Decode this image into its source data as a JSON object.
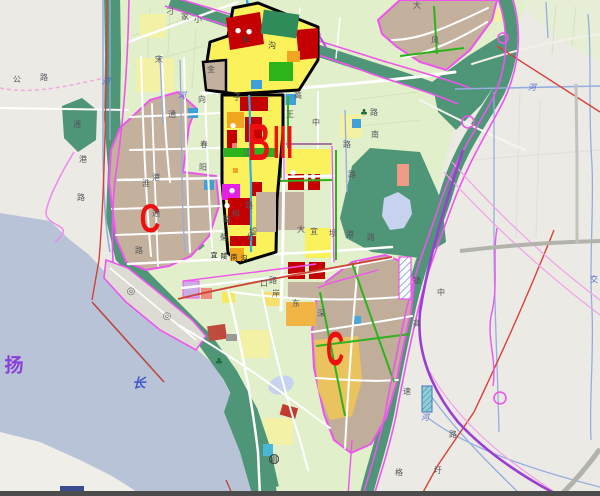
{
  "map": {
    "district_letters": [
      {
        "name": "district-label-c-west",
        "text": "C",
        "x": 150,
        "y": 219,
        "size": 40,
        "sx": 0.72,
        "c": "#ee0f0f"
      },
      {
        "name": "district-label-b",
        "text": "B",
        "x": 259,
        "y": 143,
        "size": 52,
        "sx": 0.6,
        "c": "#ee0f0f"
      },
      {
        "name": "district-label-iii",
        "text": "III",
        "x": 283,
        "y": 142,
        "size": 46,
        "sx": 0.52,
        "c": "#ee0f0f"
      },
      {
        "name": "district-label-c-south",
        "text": "C",
        "x": 335,
        "y": 350,
        "size": 48,
        "sx": 0.52,
        "c": "#ee0f0f"
      }
    ],
    "water_labels": [
      {
        "name": "river-label-yang",
        "text": "扬",
        "x": 14,
        "y": 366,
        "c": "#8a3fd8",
        "size": 19
      },
      {
        "name": "river-label-chang",
        "text": "长",
        "x": 139,
        "y": 384,
        "c": "#3c55c8",
        "size": 13,
        "i": 1
      }
    ],
    "street_labels": [
      {
        "text": "公",
        "x": 17,
        "y": 80
      },
      {
        "text": "路",
        "x": 44,
        "y": 78
      },
      {
        "text": "河",
        "x": 106,
        "y": 82,
        "c": "#4c66c8",
        "i": 1
      },
      {
        "text": "宋",
        "x": 159,
        "y": 60
      },
      {
        "text": "河",
        "x": 182,
        "y": 96,
        "c": "#4c66c8",
        "i": 1
      },
      {
        "text": "向",
        "x": 202,
        "y": 100
      },
      {
        "text": "通",
        "x": 77,
        "y": 125
      },
      {
        "text": "港",
        "x": 83,
        "y": 160
      },
      {
        "text": "路",
        "x": 81,
        "y": 198
      },
      {
        "text": "淮",
        "x": 146,
        "y": 184
      },
      {
        "text": "通",
        "x": 172,
        "y": 115
      },
      {
        "text": "港",
        "x": 156,
        "y": 178
      },
      {
        "text": "通",
        "x": 156,
        "y": 214
      },
      {
        "text": "春",
        "x": 204,
        "y": 145
      },
      {
        "text": "阳",
        "x": 203,
        "y": 168
      },
      {
        "text": "子",
        "x": 237,
        "y": 98
      },
      {
        "text": "高",
        "x": 298,
        "y": 96
      },
      {
        "text": "王",
        "x": 290,
        "y": 115
      },
      {
        "text": "江",
        "x": 247,
        "y": 153
      },
      {
        "text": "金",
        "x": 211,
        "y": 70
      },
      {
        "text": "海",
        "x": 245,
        "y": 40,
        "c": "#3a3a3a"
      },
      {
        "text": "沟",
        "x": 272,
        "y": 46,
        "c": "#3a3a3a"
      },
      {
        "text": "刁",
        "x": 170,
        "y": 12
      },
      {
        "text": "家",
        "x": 185,
        "y": 17
      },
      {
        "text": "小",
        "x": 198,
        "y": 20
      },
      {
        "text": "路",
        "x": 374,
        "y": 113
      },
      {
        "text": "南",
        "x": 375,
        "y": 135
      },
      {
        "text": "路",
        "x": 347,
        "y": 145
      },
      {
        "text": "路",
        "x": 352,
        "y": 175
      },
      {
        "text": "中",
        "x": 316,
        "y": 123
      },
      {
        "text": "路",
        "x": 249,
        "y": 206
      },
      {
        "text": "梅",
        "x": 236,
        "y": 214
      },
      {
        "text": "路",
        "x": 227,
        "y": 220
      },
      {
        "text": "墟",
        "x": 253,
        "y": 232
      },
      {
        "text": "柴",
        "x": 224,
        "y": 238
      },
      {
        "text": "堆",
        "x": 251,
        "y": 238
      },
      {
        "text": "大",
        "x": 301,
        "y": 230
      },
      {
        "text": "宜",
        "x": 314,
        "y": 232
      },
      {
        "text": "坝",
        "x": 333,
        "y": 234
      },
      {
        "text": "港",
        "x": 350,
        "y": 235
      },
      {
        "text": "路",
        "x": 371,
        "y": 238
      },
      {
        "text": "宜",
        "x": 214,
        "y": 256,
        "c": "#222222",
        "size": 7
      },
      {
        "text": "陵",
        "x": 224,
        "y": 257,
        "c": "#222222",
        "size": 7
      },
      {
        "text": "南",
        "x": 234,
        "y": 258,
        "c": "#222222",
        "size": 7
      },
      {
        "text": "沟",
        "x": 244,
        "y": 259,
        "c": "#222222",
        "size": 7
      },
      {
        "text": "路",
        "x": 273,
        "y": 281
      },
      {
        "text": "口",
        "x": 264,
        "y": 284
      },
      {
        "text": "岸",
        "x": 276,
        "y": 294
      },
      {
        "text": "东",
        "x": 296,
        "y": 304
      },
      {
        "text": "深",
        "x": 321,
        "y": 314
      },
      {
        "text": "路",
        "x": 139,
        "y": 251
      },
      {
        "text": "大",
        "x": 417,
        "y": 6
      },
      {
        "text": "风",
        "x": 435,
        "y": 41
      },
      {
        "text": "镇",
        "x": 417,
        "y": 281
      },
      {
        "text": "中",
        "x": 441,
        "y": 293
      },
      {
        "text": "高",
        "x": 417,
        "y": 324
      },
      {
        "text": "速",
        "x": 407,
        "y": 392
      },
      {
        "text": "河",
        "x": 425,
        "y": 418,
        "c": "#4c66c8",
        "i": 1
      },
      {
        "text": "路",
        "x": 453,
        "y": 435
      },
      {
        "text": "格",
        "x": 399,
        "y": 473
      },
      {
        "text": "圩",
        "x": 438,
        "y": 471
      },
      {
        "text": "河",
        "x": 532,
        "y": 88,
        "c": "#4c66c8",
        "i": 1
      },
      {
        "text": "交",
        "x": 594,
        "y": 280,
        "c": "#4c66c8"
      }
    ],
    "icons": [
      {
        "name": "port-anchorage-icon",
        "glyph": "◎",
        "x": 131,
        "y": 292,
        "c": "#6a6a6a",
        "size": 10
      },
      {
        "name": "port-anchorage-icon",
        "glyph": "◎",
        "x": 167,
        "y": 317,
        "c": "#6a6a6a",
        "size": 10
      },
      {
        "name": "facility-dot-icon",
        "glyph": "●",
        "x": 238,
        "y": 31,
        "c": "#ffffff",
        "size": 7
      },
      {
        "name": "facility-dot-icon",
        "glyph": "●",
        "x": 249,
        "y": 32,
        "c": "#ffffff",
        "size": 7
      },
      {
        "name": "facility-dot-icon",
        "glyph": "●",
        "x": 233,
        "y": 126,
        "c": "#ffffff",
        "size": 7
      },
      {
        "name": "facility-dot-icon",
        "glyph": "●",
        "x": 232,
        "y": 191,
        "c": "#ffffff",
        "size": 7
      },
      {
        "name": "facility-dot-icon",
        "glyph": "●",
        "x": 227,
        "y": 206,
        "c": "#ffffff",
        "size": 7
      },
      {
        "name": "facility-dot-icon",
        "glyph": "●",
        "x": 293,
        "y": 173,
        "c": "#ffffff",
        "size": 7
      },
      {
        "name": "facility-dot-icon",
        "glyph": "●",
        "x": 313,
        "y": 177,
        "c": "#ffffff",
        "size": 7
      },
      {
        "name": "ferry-terminal-icon",
        "glyph": "◍",
        "x": 274,
        "y": 459,
        "c": "#2e2e33",
        "size": 13
      },
      {
        "name": "tree-icon",
        "glyph": "♣",
        "x": 364,
        "y": 114,
        "c": "#1d6b38",
        "size": 9
      },
      {
        "name": "tree-icon",
        "glyph": "♣",
        "x": 219,
        "y": 363,
        "c": "#1d6b38",
        "size": 9
      }
    ],
    "colors": {
      "water": "#b9c3d8",
      "outside_land": "#eceae5",
      "farmland": "#e1efca",
      "field_yellow": "#f3f1a6",
      "greenbelt": "#4f9577",
      "block_yellow": "#fbf25b",
      "block_red": "#c40000",
      "block_orange": "#f2a51f",
      "block_green": "#2db31c",
      "block_tan": "#c3b19d",
      "block_magenta": "#e520e5",
      "block_blue": "#3f9fd8",
      "block_lavender": "#c9aee4",
      "block_salmon": "#ee8e7e",
      "block_gold": "#eac35f",
      "boundary_magenta": "#ee55ee",
      "expressway_purple": "#9a3fd2",
      "canal_blue": "#94aede",
      "river_cyan": "#2fb0e6",
      "rail_red": "#d8403a",
      "road_gray": "#b3b3ad",
      "district_letter_red": "#ee0f0f",
      "special_zone_outline": "#000000"
    }
  }
}
